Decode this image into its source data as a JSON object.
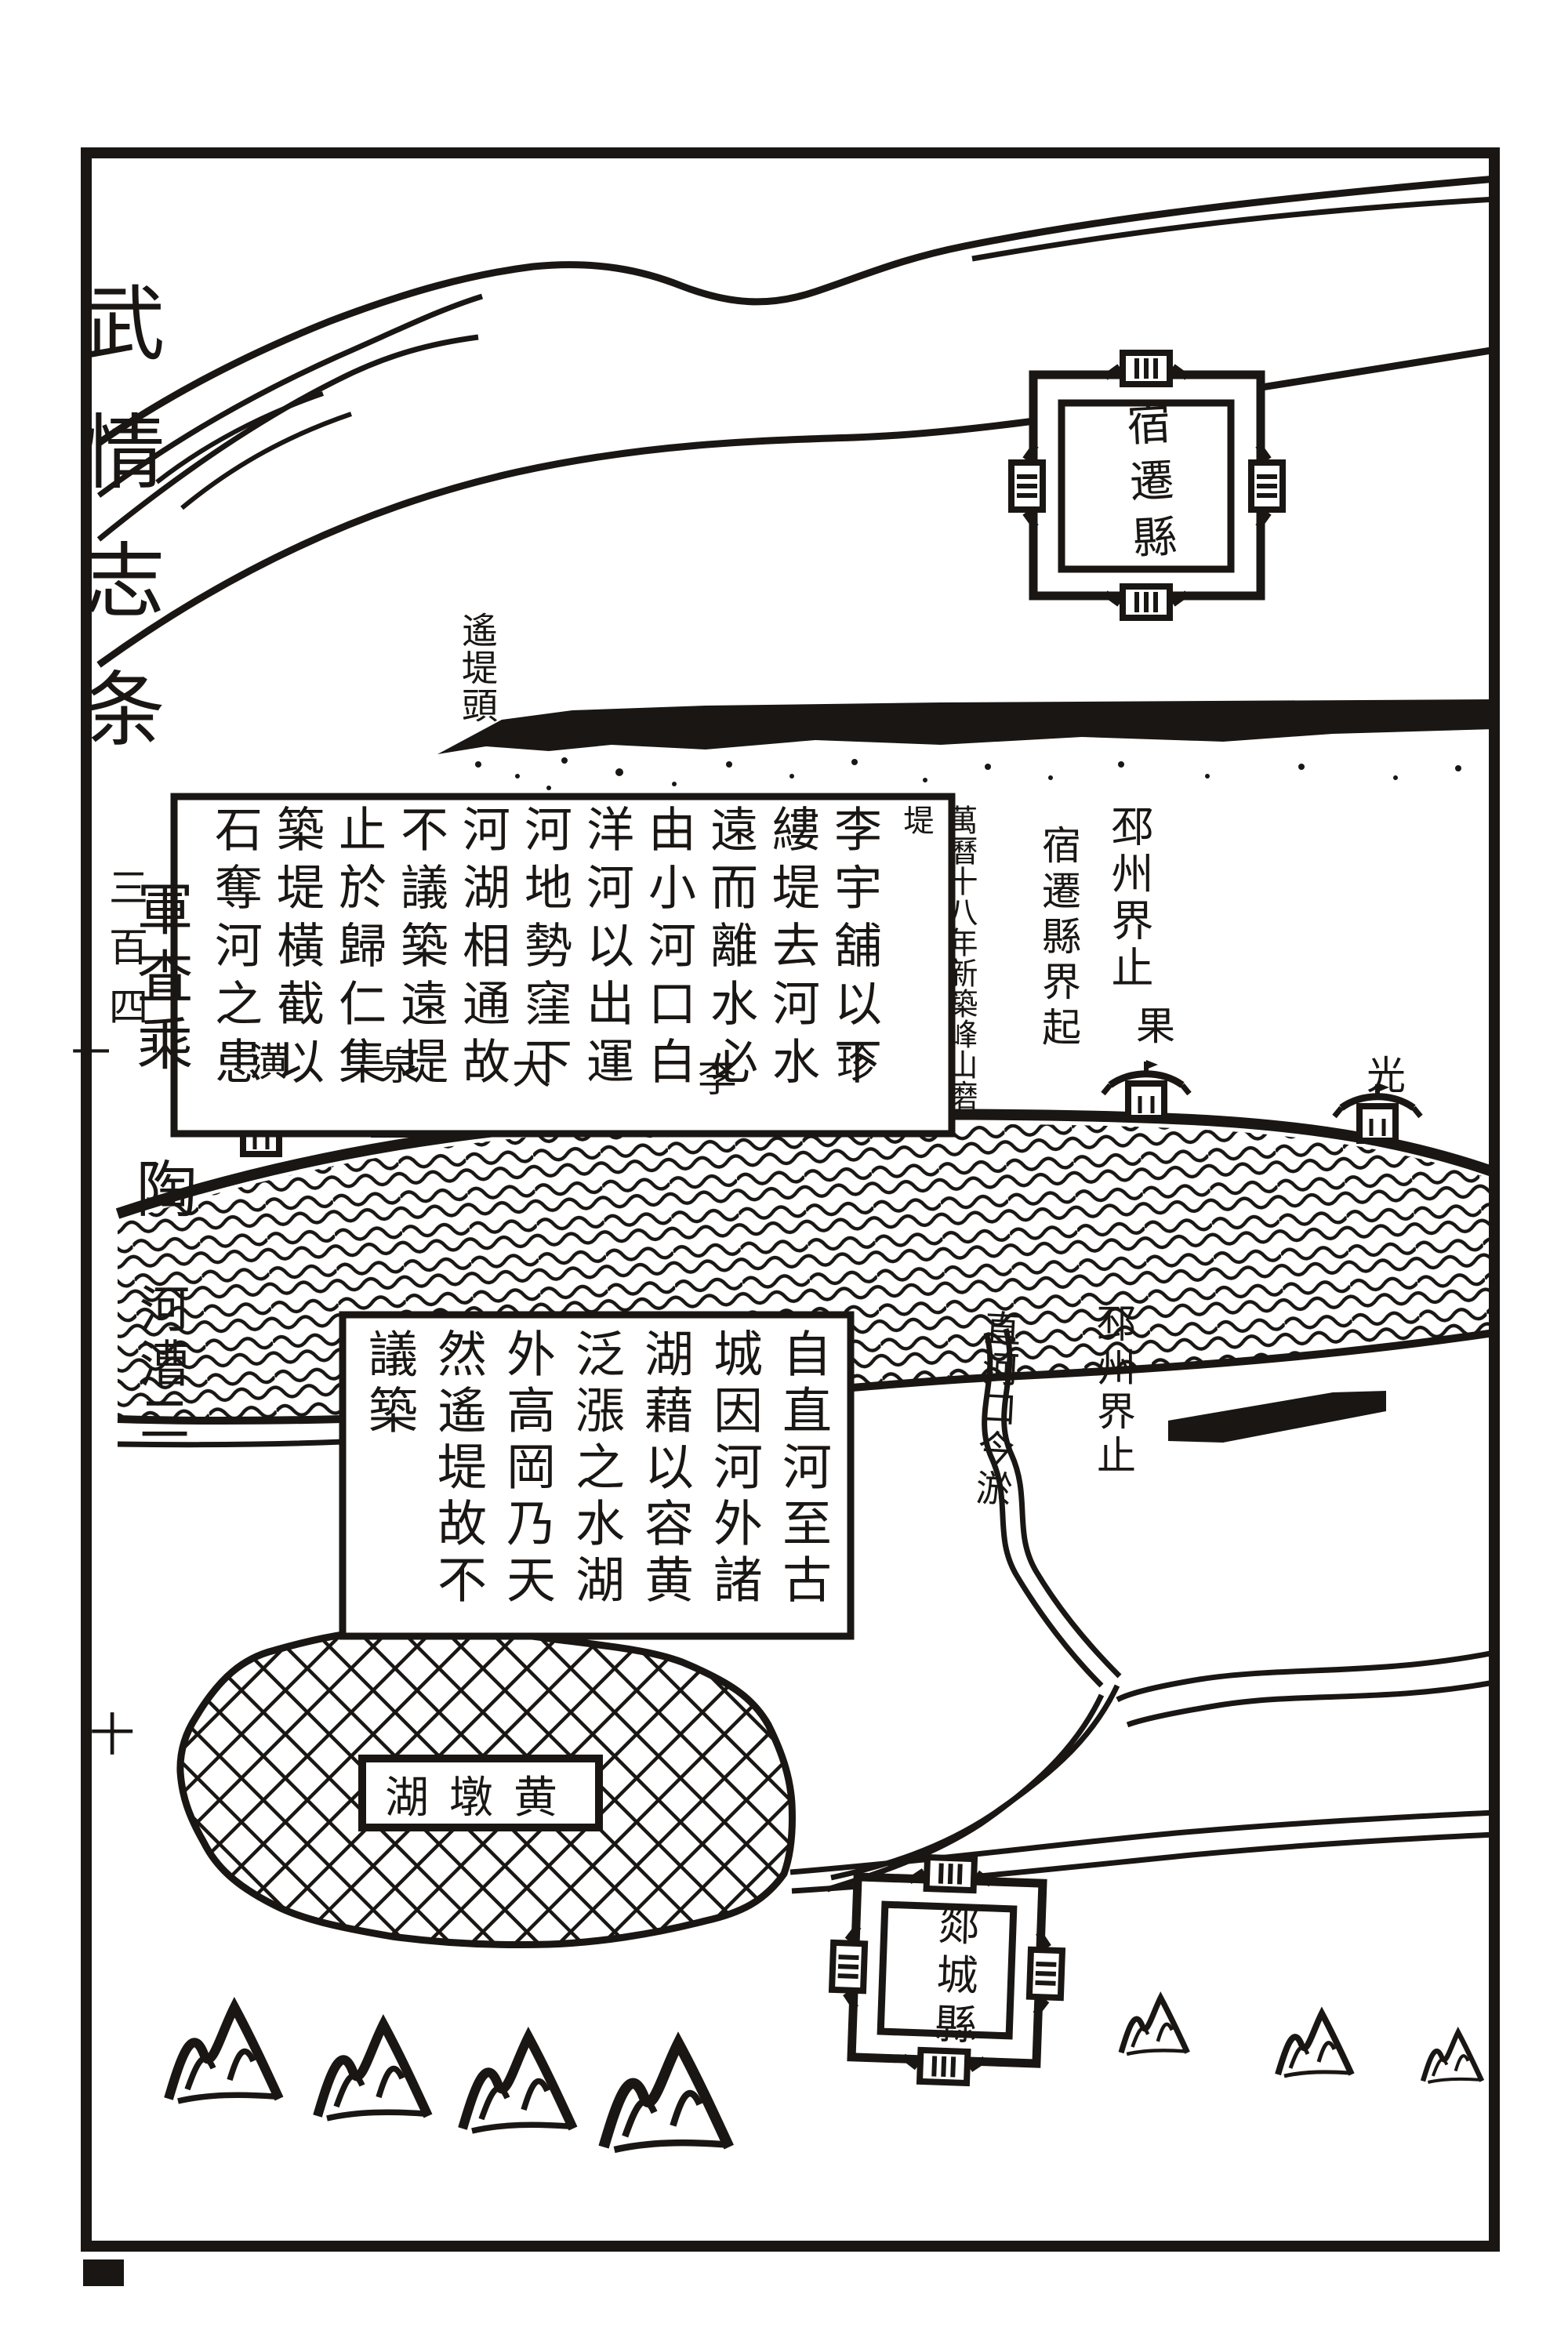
{
  "page": {
    "margin_title_main": "武情志条",
    "margin_title_vol_right": "三百四",
    "margin_title_vol_left": "一",
    "margin_note_top": "軍査乘",
    "margin_note_mid": "陶",
    "margin_note_bottom": "河漕二",
    "folio_number": "十"
  },
  "map": {
    "cities": {
      "upper": "宿遷縣",
      "lower": "郯城縣"
    },
    "labels": {
      "dike_head": "遙堤頭",
      "pizhou_boundary_upper": "邳州界止",
      "suqian_boundary_start": "宿遷縣界起",
      "pizhou_boundary_lower": "邳州界止",
      "zhihe_mouth": "直河口今淤",
      "date_note": "萬曆十八年新築峰山磨堤",
      "lake_name": "黄墩湖",
      "lake_name_display": "湖墩黄"
    },
    "stations": [
      {
        "label": "潢"
      },
      {
        "label": "泉"
      },
      {
        "label": "大"
      },
      {
        "label": "李"
      },
      {
        "label": "珍"
      },
      {
        "label": "果"
      },
      {
        "label": "光"
      }
    ],
    "upper_text_block_columns": [
      "李宇舖以下",
      "縷堤去河水",
      "遠而離水必",
      "由小河口白",
      "洋河以出運",
      "河地勢窪下",
      "河湖相通故",
      "不議築遠堤",
      "止於歸仁集",
      "築堤橫截以",
      "石奪河之患"
    ],
    "middle_text_block_columns": [
      "自直河至古",
      "城因河外諸",
      "湖藉以容黄",
      "泛漲之水湖",
      "外高岡乃天",
      "然遙堤故不",
      "議築"
    ]
  },
  "colors": {
    "ink": "#1a1613",
    "paper": "#ffffff"
  }
}
